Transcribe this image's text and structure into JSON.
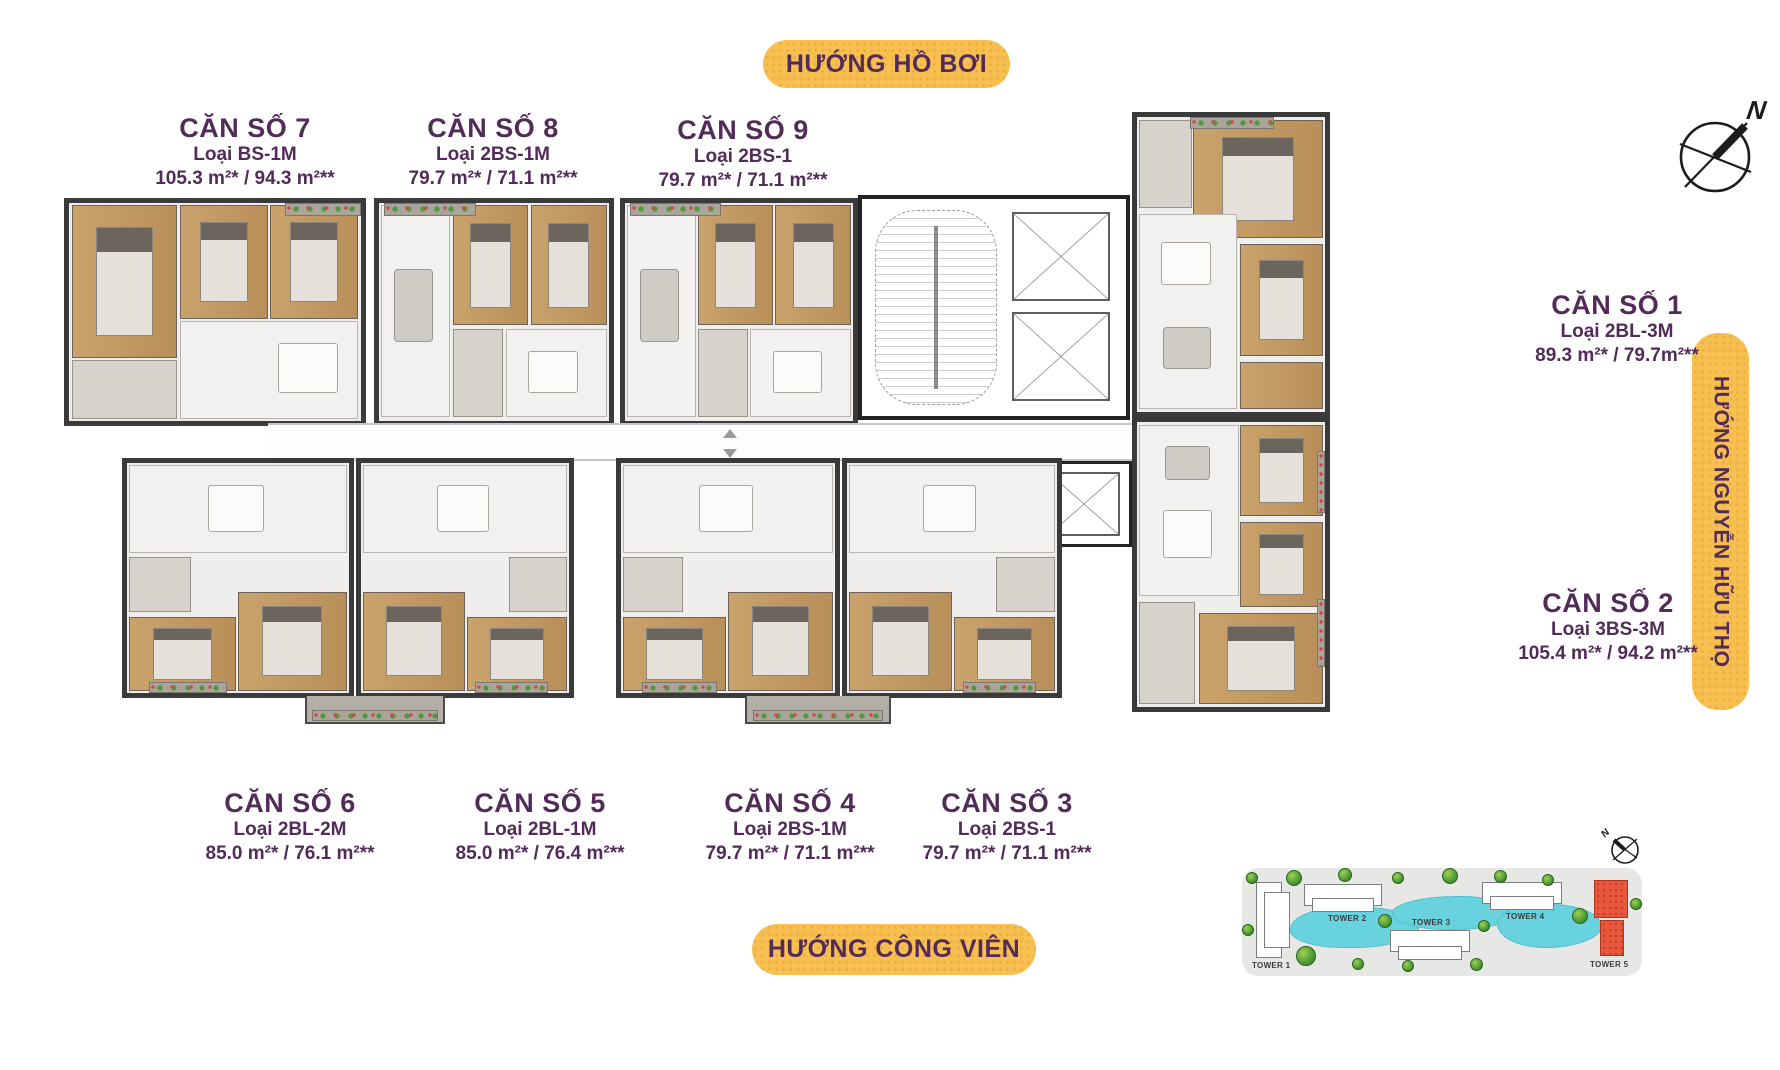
{
  "banners": {
    "top": "HƯỚNG HỒ BƠI",
    "bottom": "HƯỚNG CÔNG VIÊN",
    "right": "HƯỚNG NGUYỄN HỮU THỌ"
  },
  "compass": {
    "label": "N"
  },
  "site_map": {
    "compass_label": "N",
    "towers": [
      {
        "label": "TOWER 1"
      },
      {
        "label": "TOWER 2"
      },
      {
        "label": "TOWER 3"
      },
      {
        "label": "TOWER 4"
      },
      {
        "label": "TOWER 5"
      }
    ],
    "highlighted_tower": "TOWER 5"
  },
  "units": [
    {
      "name": "CĂN SỐ 1",
      "type": "Loại 2BL-3M",
      "area": "89.3 m²* / 79.7m²**"
    },
    {
      "name": "CĂN SỐ 2",
      "type": "Loại 3BS-3M",
      "area": "105.4 m²* / 94.2 m²**"
    },
    {
      "name": "CĂN SỐ 3",
      "type": "Loại 2BS-1",
      "area": "79.7 m²* / 71.1 m²**"
    },
    {
      "name": "CĂN SỐ 4",
      "type": "Loại 2BS-1M",
      "area": "79.7 m²* / 71.1 m²**"
    },
    {
      "name": "CĂN SỐ 5",
      "type": "Loại 2BL-1M",
      "area": "85.0 m²* / 76.4 m²**"
    },
    {
      "name": "CĂN SỐ 6",
      "type": "Loại 2BL-2M",
      "area": "85.0 m²* / 76.1 m²**"
    },
    {
      "name": "CĂN SỐ 7",
      "type": "Loại BS-1M",
      "area": "105.3 m²* / 94.3 m²**"
    },
    {
      "name": "CĂN SỐ 8",
      "type": "Loại 2BS-1M",
      "area": "79.7 m²* / 71.1 m²**"
    },
    {
      "name": "CĂN SỐ 9",
      "type": "Loại 2BS-1",
      "area": "79.7 m²* / 71.1 m²**"
    }
  ],
  "colors": {
    "banner_yellow": "#F6BF4F",
    "text_purple": "#522B59",
    "tower_highlight": "#E8573C",
    "pond_cyan": "#68D2DE",
    "wall_dark": "#3A3A3A",
    "wood_floor": "#C9A26C"
  }
}
